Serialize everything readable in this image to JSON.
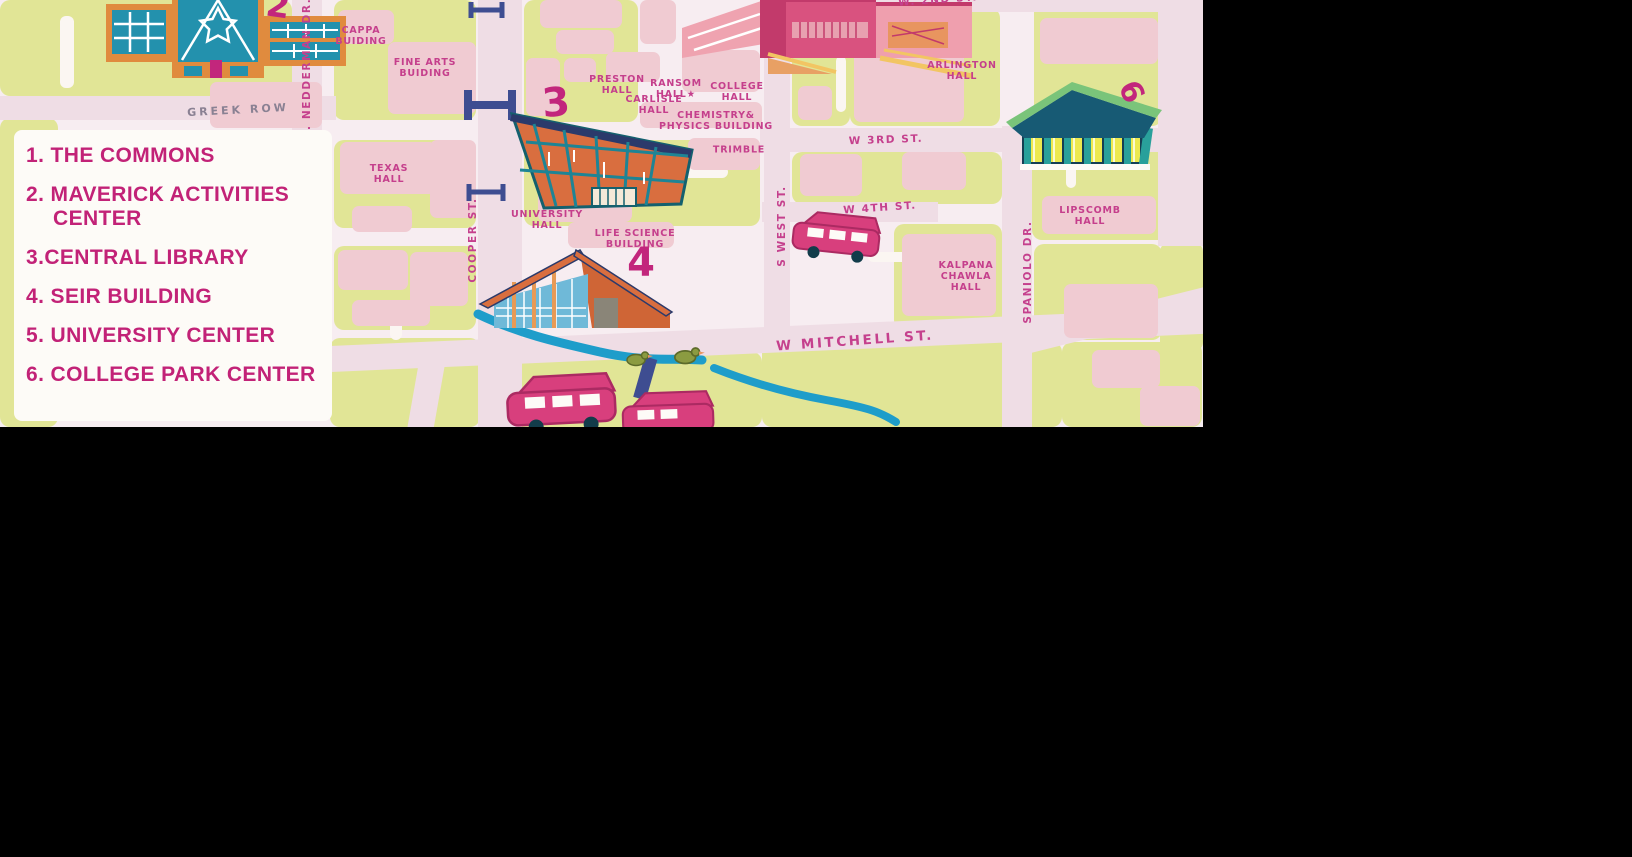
{
  "canvas": {
    "width": 1632,
    "height": 857,
    "background": "#000000"
  },
  "map": {
    "region": {
      "x": 0,
      "y": 0,
      "width": 1203,
      "height": 427
    },
    "palette": {
      "base": "#f7edf1",
      "road": "#efdde5",
      "block_green": "#e1e596",
      "block_pink": "#f0cbd2",
      "white": "#fdfbf7",
      "label_magenta": "#c53f8c",
      "legend_magenta": "#c22277",
      "street_gray": "#8a8193",
      "navy": "#3e4d91",
      "creek_blue": "#1e9dca",
      "teal": "#1e8495",
      "orange": "#d96e3f",
      "glass_blue": "#6fb9d8",
      "pink_building": "#d9527f",
      "yellow": "#ece94f",
      "green_roof": "#7ac47a",
      "bus_pink": "#d83f7d",
      "duck_green": "#8b9b41",
      "accent_yellow": "#f2c563"
    },
    "street_labels": [
      {
        "text": "GREEK ROW",
        "x": 238,
        "y": 110,
        "rot": -3,
        "style": "gray"
      },
      {
        "text": "W. NEDDERMAN DR.",
        "x": 307,
        "y": 70,
        "rot": -90,
        "style": ""
      },
      {
        "text": "COOPER ST.",
        "x": 473,
        "y": 240,
        "rot": -90,
        "style": ""
      },
      {
        "text": "W 3RD ST.",
        "x": 886,
        "y": 140,
        "rot": -2,
        "style": ""
      },
      {
        "text": "W 4TH ST.",
        "x": 880,
        "y": 208,
        "rot": -4,
        "style": ""
      },
      {
        "text": "S WEST ST.",
        "x": 782,
        "y": 226,
        "rot": -90,
        "style": ""
      },
      {
        "text": "W MITCHELL ST.",
        "x": 855,
        "y": 341,
        "rot": -4,
        "style": "magenta-large"
      },
      {
        "text": "SPANIOLO DR.",
        "x": 1028,
        "y": 272,
        "rot": -90,
        "style": ""
      },
      {
        "text": "W. 2ND ST.",
        "x": 938,
        "y": 0,
        "rot": -4,
        "style": ""
      }
    ],
    "building_labels": [
      {
        "text": "CAPPA\nBUIDING",
        "x": 361,
        "y": 36
      },
      {
        "text": "FINE ARTS\nBUIDING",
        "x": 425,
        "y": 68
      },
      {
        "text": "TEXAS\nHALL",
        "x": 389,
        "y": 174
      },
      {
        "text": "UNIVERSITY\nHALL",
        "x": 547,
        "y": 220
      },
      {
        "text": "LIFE SCIENCE\nBUILDING",
        "x": 635,
        "y": 239
      },
      {
        "text": "PRESTON\nHALL",
        "x": 617,
        "y": 85
      },
      {
        "text": "RANSOM\nHALL★",
        "x": 676,
        "y": 89
      },
      {
        "text": "CARLISLE\nHALL",
        "x": 654,
        "y": 105
      },
      {
        "text": "COLLEGE\nHALL",
        "x": 737,
        "y": 92
      },
      {
        "text": "CHEMISTRY&\nPHYSICS BUILDING",
        "x": 716,
        "y": 121
      },
      {
        "text": "TRIMBLE",
        "x": 739,
        "y": 150
      },
      {
        "text": "ARLINGTON\nHALL",
        "x": 962,
        "y": 71
      },
      {
        "text": "KALPANA\nCHAWLA\nHALL",
        "x": 966,
        "y": 277
      },
      {
        "text": "LIPSCOMB\nHALL",
        "x": 1090,
        "y": 216
      }
    ],
    "numbers": [
      {
        "text": "2",
        "x": 278,
        "y": 6,
        "rot": 8,
        "size": 34
      },
      {
        "text": "3",
        "x": 556,
        "y": 103,
        "rot": -5,
        "size": 40
      },
      {
        "text": "4",
        "x": 641,
        "y": 263,
        "rot": 0,
        "size": 40
      },
      {
        "text": "6",
        "x": 1131,
        "y": 92,
        "rot": 65,
        "size": 30
      }
    ],
    "illustrations": [
      "maverick-activities-center-building",
      "central-library-building",
      "seir-building",
      "university-center-building",
      "college-park-center-building",
      "shuttle-bus",
      "shuttle-bus",
      "shuttle-bus",
      "creek",
      "duck",
      "duck",
      "pedestrian-bridge",
      "pedestrian-bridge",
      "pedestrian-bridge",
      "creek-bridge"
    ]
  },
  "legend": {
    "background": "#fdfbf7",
    "items": [
      {
        "text": "1. THE COMMONS"
      },
      {
        "text": "2. MAVERICK ACTIVITIES CENTER"
      },
      {
        "text": "3.CENTRAL LIBRARY"
      },
      {
        "text": "4. SEIR BUILDING"
      },
      {
        "text": "5. UNIVERSITY CENTER"
      },
      {
        "text": "6. COLLEGE PARK CENTER"
      }
    ]
  }
}
